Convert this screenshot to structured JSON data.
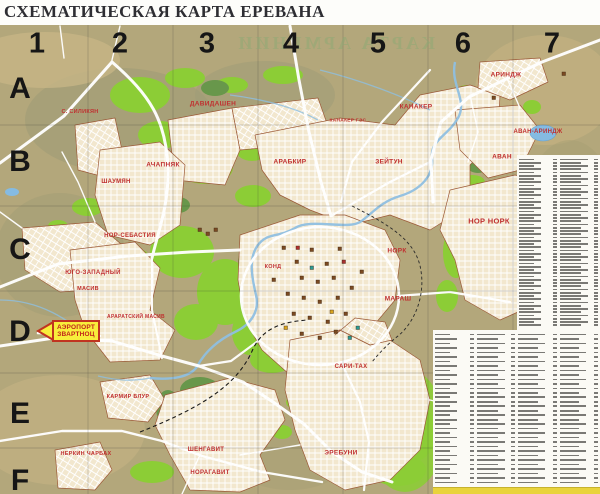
{
  "title": "СХЕМАТИЧЕСКАЯ КАРТА ЕРЕВАНА",
  "bleed_through_text": "КАРТА АРМЕНИИ",
  "map_grid": {
    "column_labels": [
      {
        "text": "1",
        "x": 37
      },
      {
        "text": "2",
        "x": 120
      },
      {
        "text": "3",
        "x": 207
      },
      {
        "text": "4",
        "x": 291
      },
      {
        "text": "5",
        "x": 378
      },
      {
        "text": "6",
        "x": 463
      },
      {
        "text": "7",
        "x": 552
      }
    ],
    "column_label_y": 44,
    "row_labels": [
      {
        "text": "A",
        "y": 89
      },
      {
        "text": "B",
        "y": 162
      },
      {
        "text": "C",
        "y": 250
      },
      {
        "text": "D",
        "y": 332
      },
      {
        "text": "E",
        "y": 414
      },
      {
        "text": "F",
        "y": 481
      }
    ],
    "row_label_x": 20
  },
  "district_labels": [
    {
      "text": "С. СИЛИКЯН",
      "x": 80,
      "y": 112,
      "size": 5.5
    },
    {
      "text": "ДАВИДАШЕН",
      "x": 213,
      "y": 104,
      "size": 6.5
    },
    {
      "text": "АРИНДЖ",
      "x": 506,
      "y": 75,
      "size": 6.5
    },
    {
      "text": "КАНАКЕР",
      "x": 416,
      "y": 107,
      "size": 6.5
    },
    {
      "text": "КАНАКЕР ГЭС",
      "x": 348,
      "y": 121,
      "size": 4.8
    },
    {
      "text": "АВАН-АРИНДЖ",
      "x": 538,
      "y": 132,
      "size": 6
    },
    {
      "text": "АВАН",
      "x": 502,
      "y": 157,
      "size": 6.5
    },
    {
      "text": "АЧАПНЯК",
      "x": 163,
      "y": 165,
      "size": 6.5
    },
    {
      "text": "ШАУМЯН",
      "x": 116,
      "y": 182,
      "size": 6
    },
    {
      "text": "АРАБКИР",
      "x": 290,
      "y": 162,
      "size": 6.5
    },
    {
      "text": "ЗЕЙТУН",
      "x": 389,
      "y": 162,
      "size": 6.5
    },
    {
      "text": "НОР-СЕБАСТИЯ",
      "x": 130,
      "y": 236,
      "size": 6
    },
    {
      "text": "НОР НОРК",
      "x": 489,
      "y": 221,
      "size": 7.5
    },
    {
      "text": "НОРК",
      "x": 397,
      "y": 251,
      "size": 6.5
    },
    {
      "text": "КОНД",
      "x": 273,
      "y": 267,
      "size": 5.5
    },
    {
      "text": "МАРАШ",
      "x": 398,
      "y": 299,
      "size": 6.5
    },
    {
      "text": "ЮГО-ЗАПАДНЫЙ",
      "x": 93,
      "y": 273,
      "size": 6
    },
    {
      "text": "МАСИВ",
      "x": 88,
      "y": 289,
      "size": 5.5
    },
    {
      "text": "АРАРАТСКИЙ МАСИВ",
      "x": 136,
      "y": 317,
      "size": 5
    },
    {
      "text": "КАРМИР БЛУР",
      "x": 128,
      "y": 397,
      "size": 5.5
    },
    {
      "text": "НЕРКИН ЧАРБАХ",
      "x": 86,
      "y": 454,
      "size": 5.5
    },
    {
      "text": "ШЕНГАВИТ",
      "x": 206,
      "y": 450,
      "size": 6
    },
    {
      "text": "НОРАГАВИТ",
      "x": 210,
      "y": 473,
      "size": 6
    },
    {
      "text": "САРИ-ТАХ",
      "x": 351,
      "y": 367,
      "size": 6
    },
    {
      "text": "ЭРЕБУНИ",
      "x": 341,
      "y": 453,
      "size": 6.5
    }
  ],
  "airport_sign": {
    "line1": "АЭРОПОРТ",
    "line2": "ЗВАРТНОЦ"
  },
  "street_index": {
    "description": "Alphabetical street index with grid references — print too small to be legible",
    "upper_panel": {
      "columns": 2,
      "rows": 52
    },
    "lower_panel": {
      "columns": 4,
      "rows": 34
    }
  },
  "colors": {
    "background_olive": "#b3a77b",
    "parkland_green": "#8ccd36",
    "dark_green": "#68974b",
    "urban_beige": "#f2e7ce",
    "water_blue": "#8fbfe0",
    "district_label_red": "#c03030",
    "boundary_brown": "#9c5a38",
    "index_background": "#fbfaf5",
    "sign_yellow": "#f8ee3b",
    "sign_red": "#c03420"
  }
}
